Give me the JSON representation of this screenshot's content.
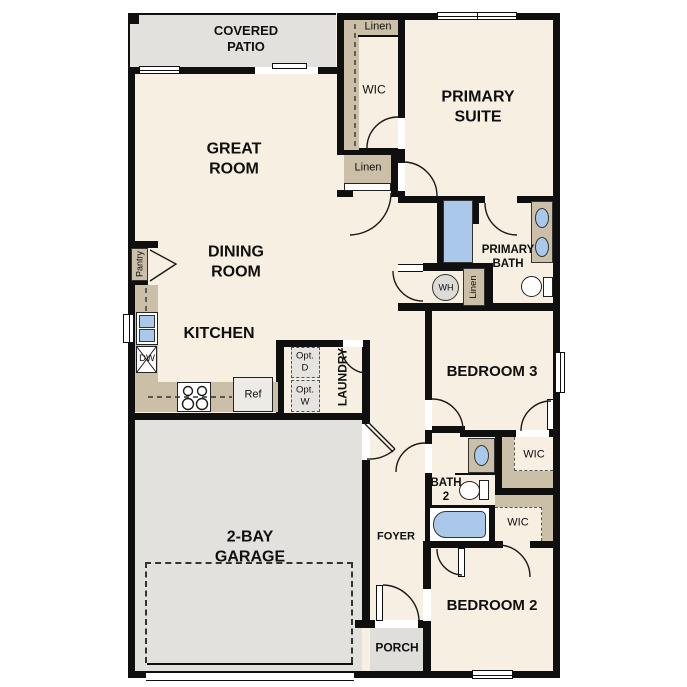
{
  "plan": {
    "title": "single-story floor plan",
    "rooms": {
      "covered_patio": "COVERED\nPATIO",
      "great_room": "GREAT\nROOM",
      "dining_room": "DINING\nROOM",
      "kitchen": "KITCHEN",
      "primary_suite": "PRIMARY\nSUITE",
      "primary_bath": "PRIMARY\nBATH",
      "bedroom3": "BEDROOM 3",
      "bedroom2": "BEDROOM 2",
      "bath2": "BATH\n2",
      "garage": "2-BAY\nGARAGE",
      "foyer": "FOYER",
      "porch": "PORCH",
      "laundry": "LAUNDRY"
    },
    "closets": {
      "wic_primary": "WIC",
      "wic_bedroom3": "WIC",
      "wic_bedroom2": "WIC",
      "linen_top": "Linen",
      "linen_mid": "Linen",
      "linen_hall": "Linen",
      "pantry": "Pantry"
    },
    "appliances": {
      "water_heater": "WH",
      "dishwasher": "DW",
      "refrigerator": "Ref",
      "optional_dryer": "Opt.\nD",
      "optional_washer": "Opt.\nW"
    },
    "colors": {
      "floor": "#f6efe2",
      "outdoor": "#e2e1de",
      "casework": "#cbbfa8",
      "fixture_blue": "#a9c8ea",
      "wall": "#0f0f0f"
    }
  }
}
